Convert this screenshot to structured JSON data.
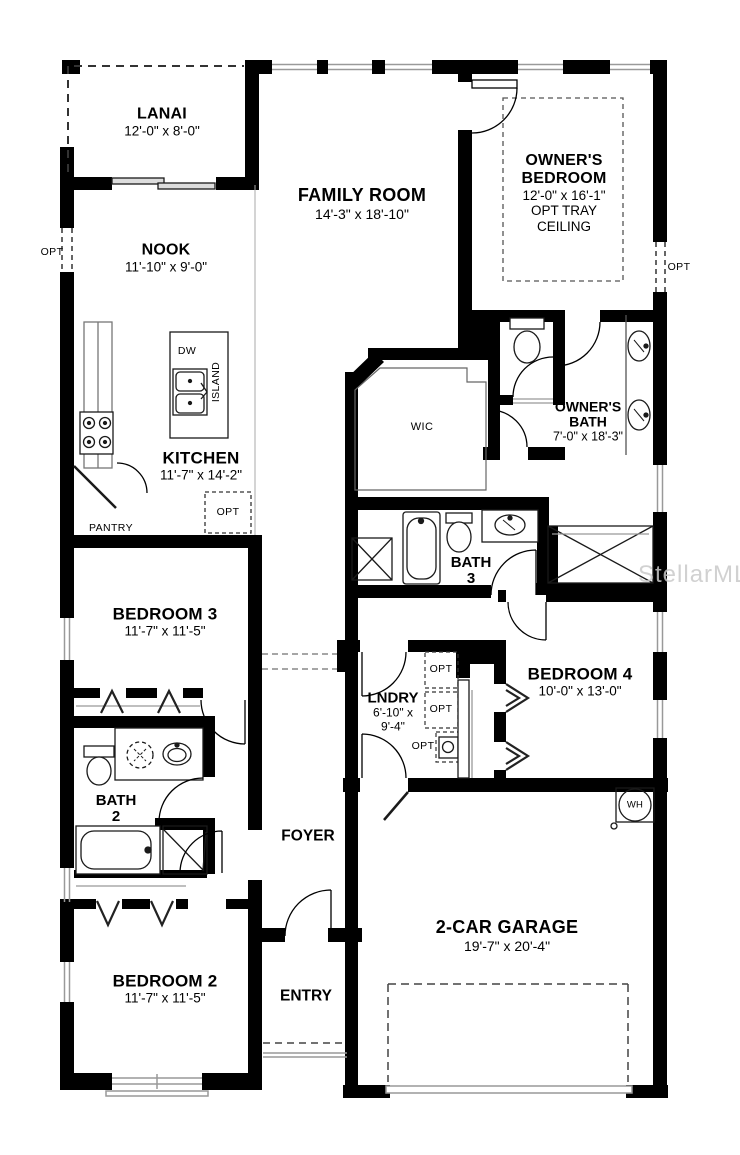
{
  "watermark": "StellarMLS",
  "rooms": {
    "lanai": {
      "name": "LANAI",
      "dims": "12'-0\" x 8'-0\""
    },
    "family_room": {
      "name": "FAMILY ROOM",
      "dims": "14'-3\" x 18'-10\""
    },
    "owners_bedroom": {
      "name_line1": "OWNER'S",
      "name_line2": "BEDROOM",
      "dims": "12'-0\" x 16'-1\"",
      "note_line1": "OPT TRAY",
      "note_line2": "CEILING"
    },
    "nook": {
      "name": "NOOK",
      "dims": "11'-10\" x 9'-0\""
    },
    "kitchen": {
      "name": "KITCHEN",
      "dims": "11'-7\" x 14'-2\""
    },
    "owners_bath": {
      "name_line1": "OWNER'S",
      "name_line2": "BATH",
      "dims": "7'-0\" x 18'-3\""
    },
    "wic": {
      "name": "WIC"
    },
    "bath_3": {
      "name": "BATH",
      "number": "3"
    },
    "bedroom_3": {
      "name": "BEDROOM 3",
      "dims": "11'-7\" x 11'-5\""
    },
    "bedroom_4": {
      "name": "BEDROOM 4",
      "dims": "10'-0\" x 13'-0\""
    },
    "laundry": {
      "name": "LNDRY",
      "dims_line1": "6'-10\" x",
      "dims_line2": "9'-4\""
    },
    "bath_2": {
      "name": "BATH",
      "number": "2"
    },
    "foyer": {
      "name": "FOYER"
    },
    "bedroom_2": {
      "name": "BEDROOM 2",
      "dims": "11'-7\" x 11'-5\""
    },
    "entry": {
      "name": "ENTRY"
    },
    "garage": {
      "name": "2-CAR GARAGE",
      "dims": "19'-7\" x 20'-4\""
    }
  },
  "fixture_labels": {
    "dishwasher": "DW",
    "island": "ISLAND",
    "pantry": "PANTRY",
    "water_heater": "WH"
  },
  "opt_labels": {
    "left_wall": "OPT",
    "right_wall": "OPT",
    "kitchen": "OPT",
    "laundry_1": "OPT",
    "laundry_2": "OPT",
    "laundry_3": "OPT"
  },
  "colors": {
    "wall": "#000000",
    "fixture": "#1a1a1a",
    "sill": "#999999",
    "watermark": "#c9c9c9"
  }
}
